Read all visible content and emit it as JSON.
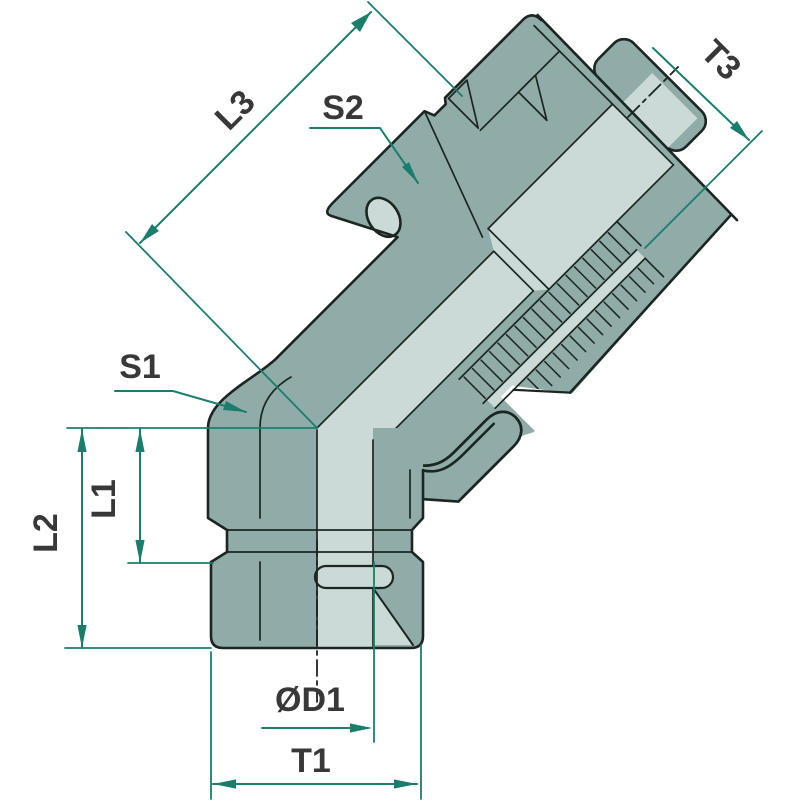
{
  "drawing": {
    "kind": "technical dimension drawing",
    "subject": "45-degree elbow fitting, male stud bottom port with swivel nut on angled branch"
  },
  "dimension_labels": {
    "l3": "L3",
    "s2": "S2",
    "t3": "T3",
    "s1": "S1",
    "l1": "L1",
    "l2": "L2",
    "d1": "ØD1",
    "t1": "T1"
  },
  "colors": {
    "dimension_line": "#1b7e6d",
    "label_text": "#383838",
    "body_fill": "#8faca8",
    "highlight_fill": "#cbdad6",
    "outline": "#1c2522",
    "background": "#ffffff"
  }
}
